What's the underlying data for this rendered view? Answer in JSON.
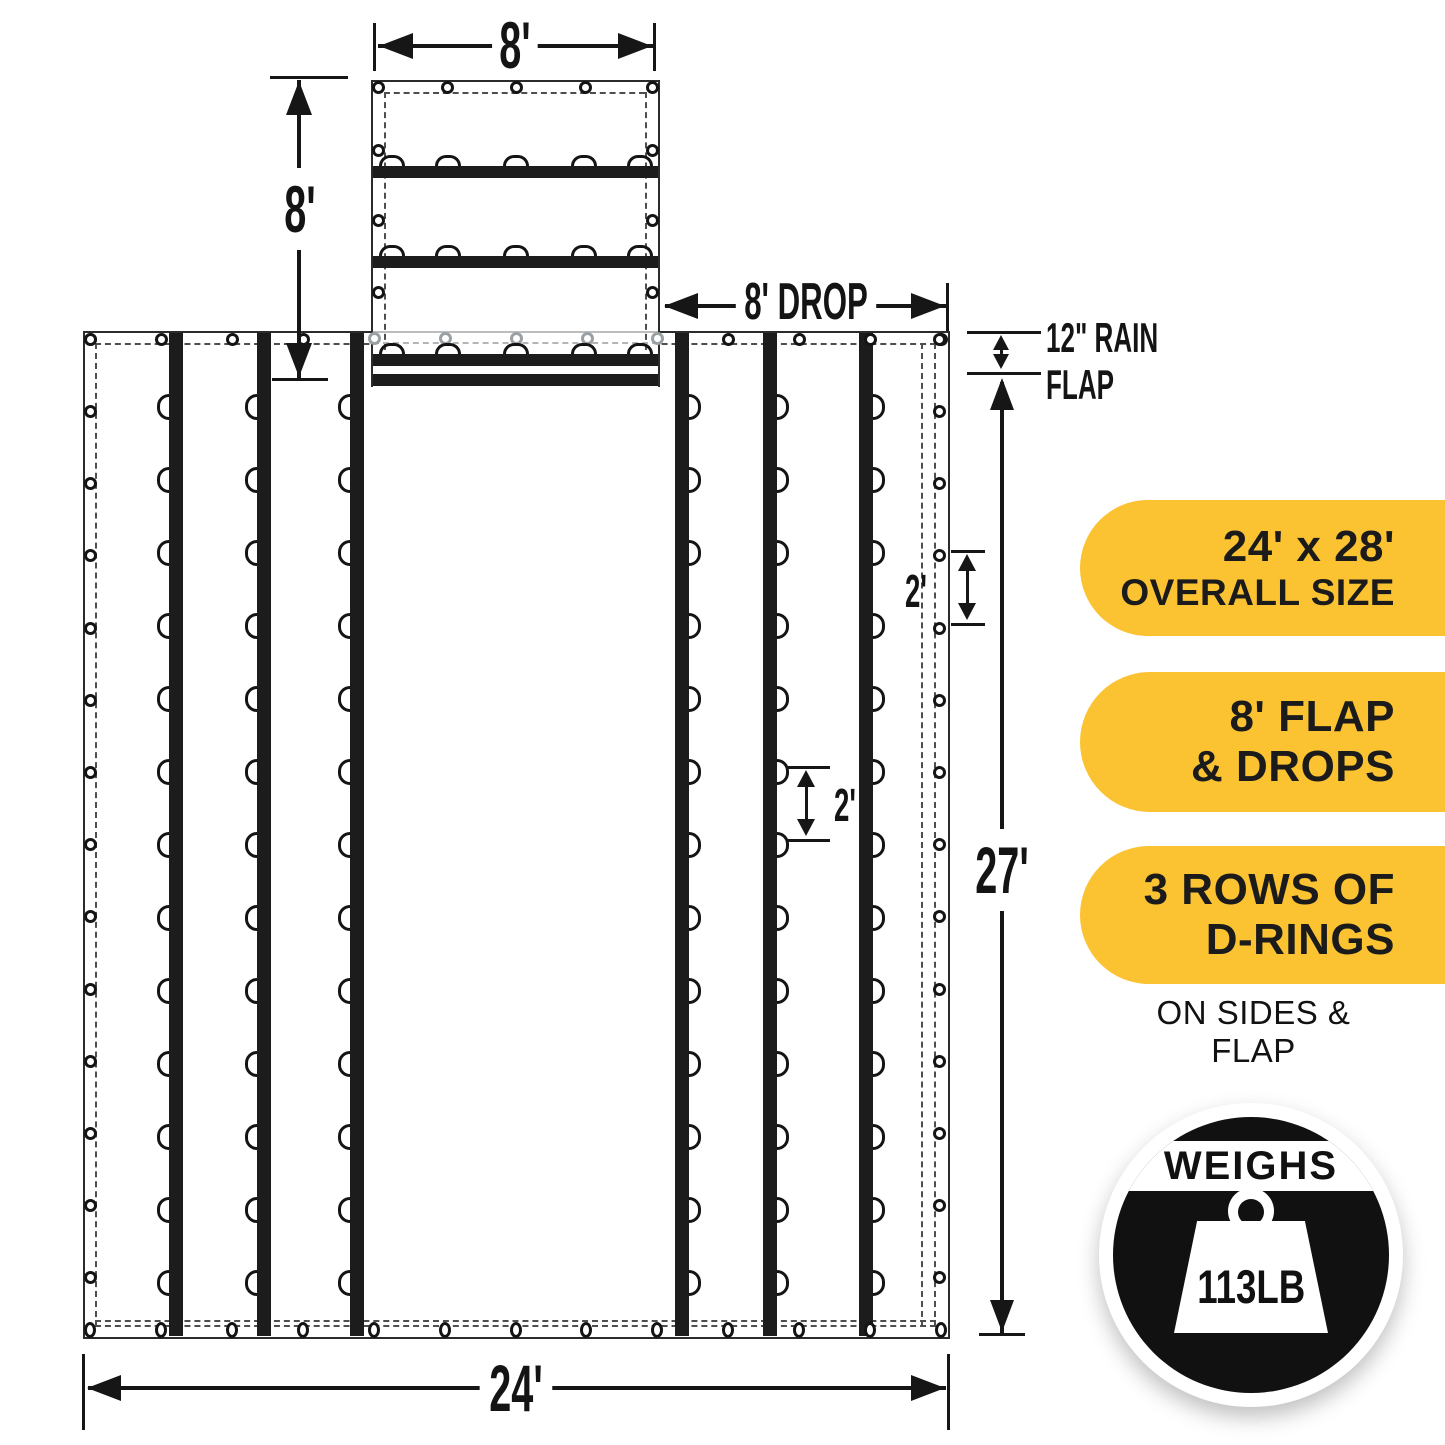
{
  "page": {
    "background": "#ffffff"
  },
  "diagram": {
    "dimensions": {
      "flap_width": "8'",
      "flap_length": "8'",
      "drop": "8' DROP",
      "rain_flap_line1": "12\" RAIN",
      "rain_flap_line2": "FLAP",
      "tarp_length": "27'",
      "tarp_width": "24'",
      "grommet_spacing": "2'",
      "d_ring_spacing": "2'"
    },
    "figure": {
      "type": "flatbed-lumber-tarp-spec-diagram",
      "vertical_straps": 6,
      "d_rings_per_strap": 13,
      "flap_strap_rows": 3,
      "d_rings_per_flap_row": 5,
      "ink_color": "#161616",
      "hidden_edge_color": "#a8adb0"
    }
  },
  "feature_badges": {
    "accent_color": "#FBC331",
    "text_color": "#1B1B1B",
    "items": [
      {
        "line1": "24' x 28'",
        "line2": "OVERALL SIZE"
      },
      {
        "line1": "8' FLAP",
        "line2": "& DROPS"
      },
      {
        "line1": "3 ROWS OF",
        "line2": "D-RINGS"
      }
    ],
    "caption": "ON SIDES & FLAP"
  },
  "weight_badge": {
    "label": "WEIGHS",
    "value": "113LB",
    "icon": "kettlebell-weight-icon",
    "bg_color": "#111111"
  }
}
